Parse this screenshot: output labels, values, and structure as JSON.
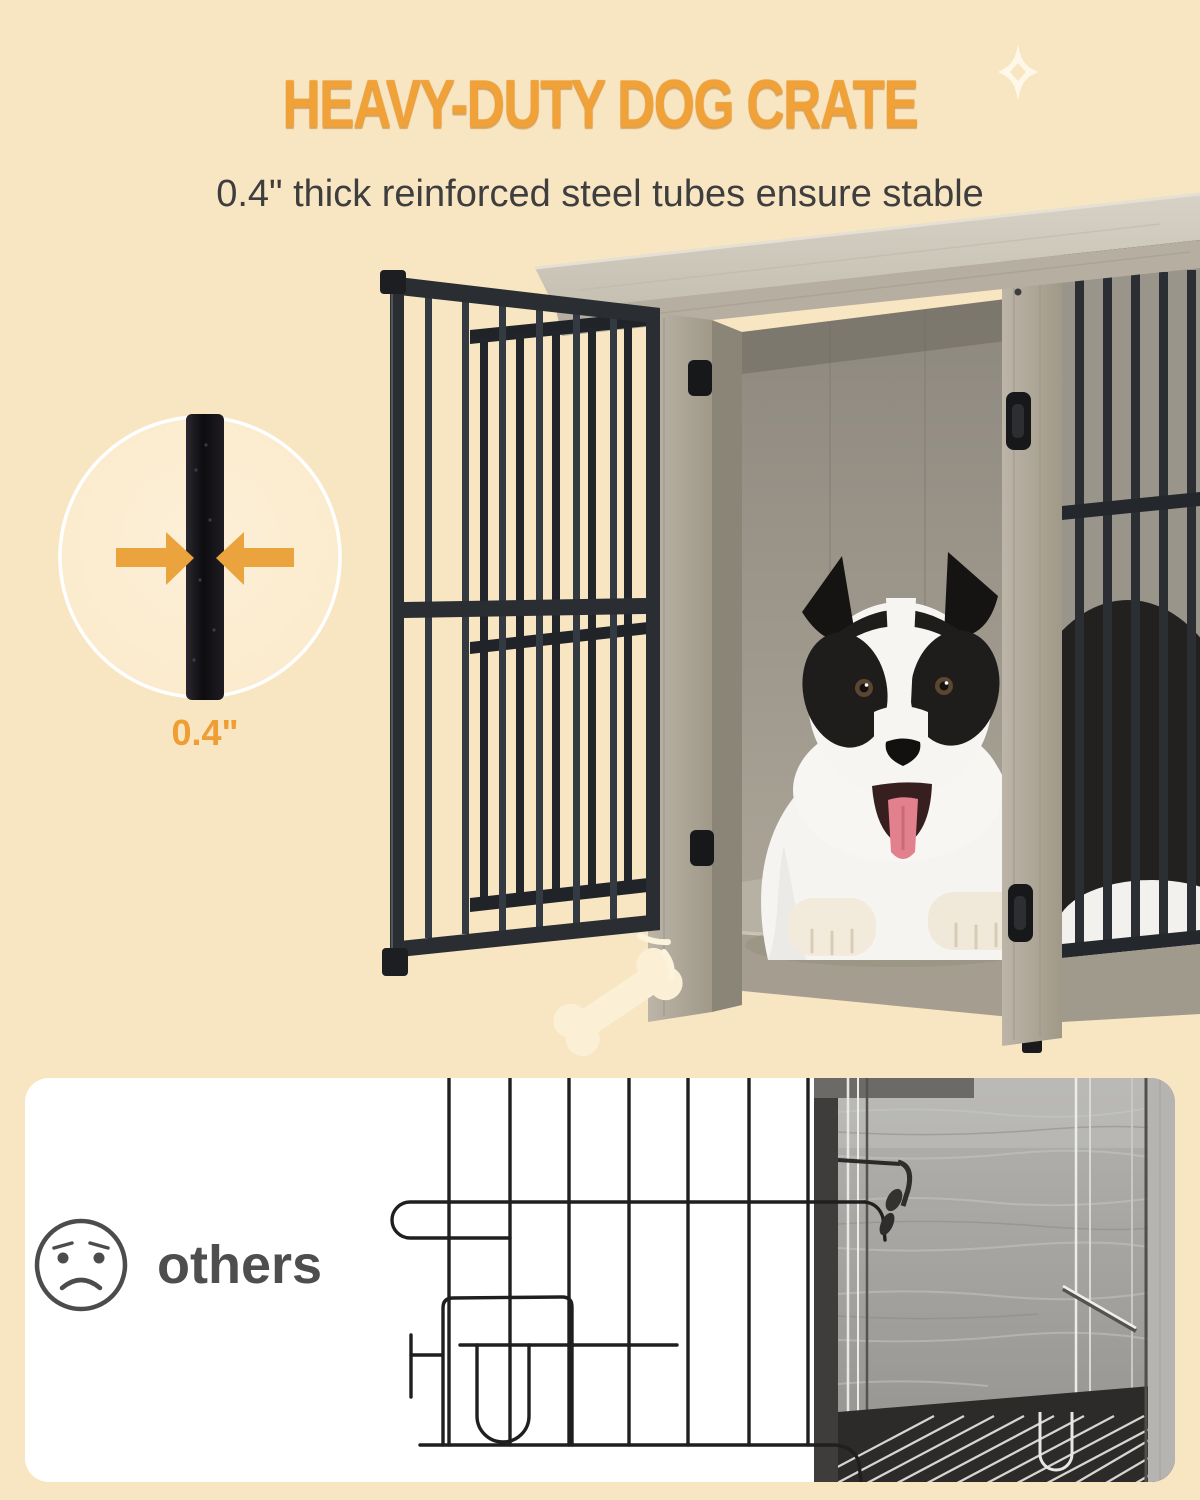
{
  "page": {
    "background_color": "#f8e5c2",
    "panel_color": "#ffffff"
  },
  "header": {
    "title": "HEAVY-DUTY DOG CRATE",
    "subtitle": "0.4\" thick reinforced steel tubes ensure stable",
    "title_color": "#f0a238",
    "subtitle_color": "#3e3e3e"
  },
  "tube_badge": {
    "label": "0.4\"",
    "label_color": "#ee9e33",
    "arrow_color": "#eba43d"
  },
  "comparison_panel": {
    "label": "others",
    "label_color": "#4e4e4e"
  },
  "colors": {
    "steel_black": "#2b2f34",
    "wood_light": "#cfc9bc",
    "wood_medium": "#aaa397",
    "wire_black": "#1f1f1f",
    "photo_grey": "#a3a19e"
  }
}
